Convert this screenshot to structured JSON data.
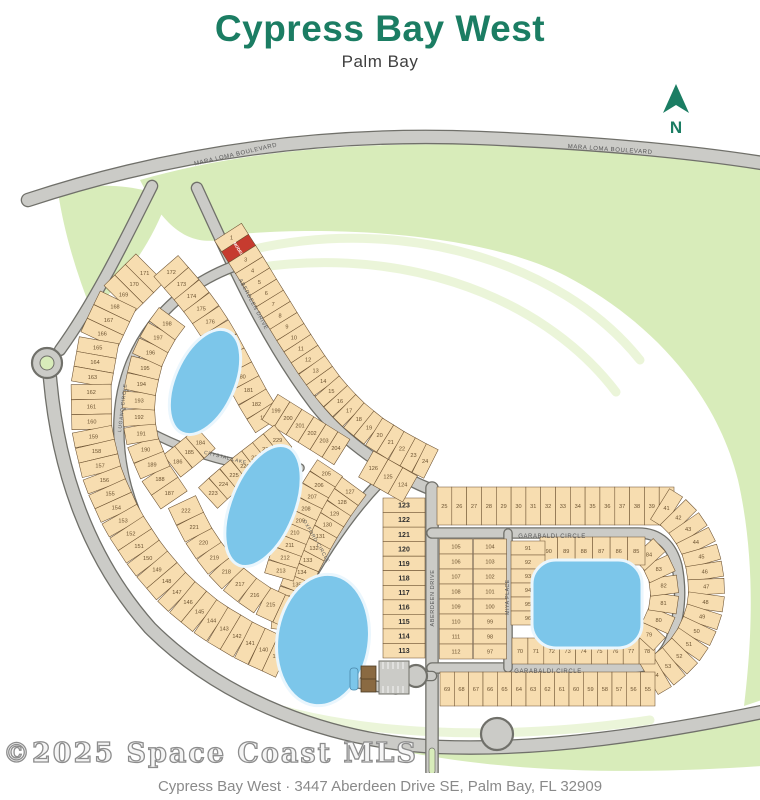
{
  "title": "Cypress Bay West",
  "subtitle": "Palm Bay",
  "watermark": "©2025 Space Coast MLS",
  "footer": "Cypress Bay West  ·  3447 Aberdeen Drive SE, Palm Bay, FL 32909",
  "north_label": "N",
  "colors": {
    "title_teal": "#1b7d63",
    "lot_fill": "#f7ddb0",
    "lot_stroke": "#6a4f2e",
    "lot_number": "#6b5230",
    "lot_number_bold": "#2f2f2f",
    "road_fill": "#cbcbc7",
    "road_casing": "#70706a",
    "green": "#d8ecba",
    "green_light": "#e6f3cf",
    "lake": "#7cc6ea",
    "lake_edge": "#eaf6fd",
    "model_red": "#c63b2f",
    "label_gray": "#575757",
    "clubhouse_brown": "#8a6a42"
  },
  "map": {
    "greens": [
      {
        "name": "green-top-right",
        "d": "M 140,180 C 300,134 500,136 762,166 L 762,700 L 744,706 C 752,640 756,560 738,480 C 716,392 650,320 566,276 C 480,232 330,226 240,234 C 200,250 170,240 140,180 Z"
      },
      {
        "name": "green-top-left",
        "d": "M 58,192 C 95,182 135,184 168,198 C 150,248 122,282 92,312 C 76,272 64,232 58,192 Z"
      },
      {
        "name": "green-bottom",
        "d": "M 150,636 C 240,718 360,752 470,752 C 600,752 690,735 762,714 L 762,766 C 560,780 300,772 150,636 Z"
      }
    ],
    "green_stripes": [
      {
        "d": "M 250,250 C 400,215 560,260 640,360"
      },
      {
        "d": "M 232,272 C 390,240 540,292 616,392"
      },
      {
        "d": "M 250,700 C 350,736 500,742 650,720"
      }
    ],
    "roads": [
      {
        "name": "mara-loma-boulevard",
        "d": "M 28,200 C 180,150 330,132 480,138 C 600,143 692,152 762,163",
        "w": 12
      },
      {
        "name": "entry-branch",
        "d": "M 152,186 C 125,240 96,300 60,350",
        "w": 10
      },
      {
        "name": "perimeter-boulevard",
        "d": "M 50,378 C 58,470 88,558 150,628 C 222,700 330,742 440,747 C 545,751 660,733 762,712",
        "w": 12
      },
      {
        "name": "aberdeen-drive-upper",
        "d": "M 197,188 C 228,255 262,335 315,405 C 345,443 390,473 432,490",
        "w": 10
      },
      {
        "name": "aberdeen-drive-lower",
        "d": "M 432,488 L 432,772",
        "w": 11
      },
      {
        "name": "garabaldi-circle-loop",
        "d": "M 432,533 L 638,533 C 660,533 672,546 677,566 C 682,592 680,616 671,639 C 663,660 648,668 628,668 L 432,668",
        "w": 9
      },
      {
        "name": "miya-place",
        "d": "M 508,533 L 508,668",
        "w": 7
      },
      {
        "name": "lugano-circle",
        "d": "M 240,264 C 165,290 122,350 119,420 C 116,495 150,562 207,606 C 237,630 272,650 312,661",
        "w": 9
      },
      {
        "name": "oxford-circle",
        "d": "M 390,472 C 355,505 325,550 301,594 C 287,620 284,646 302,660 C 322,676 355,684 396,689",
        "w": 9
      },
      {
        "name": "crystal-lake-street",
        "d": "M 150,432 C 200,458 252,471 300,468",
        "w": 7
      },
      {
        "name": "amenity-stub",
        "d": "M 432,676 L 398,676",
        "w": 8
      }
    ],
    "road_circles": [
      {
        "name": "roundabout",
        "cx": 47,
        "cy": 363,
        "r": 15,
        "inner_green": 7
      },
      {
        "name": "cul-de-sac-bulb",
        "cx": 497,
        "cy": 734,
        "r": 16
      },
      {
        "name": "amenity-cul-de-sac",
        "cx": 416,
        "cy": 676,
        "r": 11
      }
    ],
    "lakes": [
      {
        "name": "lake-1",
        "type": "ellipse",
        "cx": 205,
        "cy": 382,
        "rx": 30,
        "ry": 56,
        "rot": 24
      },
      {
        "name": "lake-2",
        "type": "ellipse",
        "cx": 263,
        "cy": 506,
        "rx": 32,
        "ry": 64,
        "rot": 22
      },
      {
        "name": "lake-3",
        "type": "ellipse",
        "cx": 323,
        "cy": 640,
        "rx": 46,
        "ry": 66,
        "rot": 8
      },
      {
        "name": "lake-4",
        "type": "rect",
        "x": 532,
        "y": 560,
        "w": 110,
        "h": 88,
        "r": 24
      }
    ],
    "lot_groups": [
      {
        "name": "aberdeen-east-1-24",
        "depth": 32,
        "line": [
          [
            228,
            232
          ],
          [
            246,
            260
          ],
          [
            262,
            286
          ],
          [
            278,
            312
          ],
          [
            294,
            338
          ],
          [
            311,
            364
          ],
          [
            329,
            389
          ],
          [
            350,
            412
          ],
          [
            373,
            431
          ],
          [
            397,
            446
          ],
          [
            419,
            458
          ],
          [
            431,
            464
          ]
        ],
        "numbers": [
          "1",
          "MODEL",
          "3",
          "4",
          "5",
          "6",
          "7",
          "8",
          "9",
          "10",
          "11",
          "12",
          "13",
          "14",
          "15",
          "16",
          "17",
          "18",
          "19",
          "20",
          "21",
          "22",
          "23",
          "24"
        ]
      },
      {
        "name": "garabaldi-top-25-40",
        "depth": 38,
        "line": [
          [
            437,
            506
          ],
          [
            674,
            506
          ]
        ],
        "numbers": [
          "25",
          "26",
          "27",
          "28",
          "29",
          "30",
          "31",
          "32",
          "33",
          "34",
          "35",
          "36",
          "37",
          "38",
          "39",
          "40"
        ]
      },
      {
        "name": "garabaldi-east-41-54",
        "depth": 36,
        "line": [
          [
            660,
            504
          ],
          [
            676,
            514
          ],
          [
            689,
            529
          ],
          [
            699,
            548
          ],
          [
            705,
            569
          ],
          [
            707,
            591
          ],
          [
            704,
            613
          ],
          [
            696,
            634
          ],
          [
            683,
            653
          ],
          [
            666,
            669
          ],
          [
            649,
            679
          ]
        ],
        "numbers": [
          "41",
          "42",
          "43",
          "44",
          "45",
          "46",
          "47",
          "48",
          "49",
          "50",
          "51",
          "52",
          "53",
          "54"
        ]
      },
      {
        "name": "garabaldi-bottom-55-69",
        "depth": 34,
        "line": [
          [
            440,
            689
          ],
          [
            655,
            689
          ]
        ],
        "numbers": [
          "69",
          "68",
          "67",
          "66",
          "65",
          "64",
          "63",
          "62",
          "61",
          "60",
          "59",
          "58",
          "57",
          "56",
          "55"
        ]
      },
      {
        "name": "inner-row-70-78",
        "depth": 26,
        "line": [
          [
            512,
            651
          ],
          [
            655,
            651
          ]
        ],
        "numbers": [
          "70",
          "71",
          "72",
          "73",
          "74",
          "75",
          "76",
          "77",
          "78"
        ]
      },
      {
        "name": "lake-east-79-84",
        "depth": 28,
        "line": [
          [
            643,
            641
          ],
          [
            656,
            627
          ],
          [
            663,
            610
          ],
          [
            665,
            592
          ],
          [
            662,
            574
          ],
          [
            654,
            559
          ],
          [
            643,
            548
          ]
        ],
        "numbers": [
          "79",
          "80",
          "81",
          "82",
          "83",
          "84"
        ]
      },
      {
        "name": "lake-north-85-90",
        "depth": 28,
        "line": [
          [
            645,
            551
          ],
          [
            540,
            551
          ]
        ],
        "numbers": [
          "85",
          "86",
          "87",
          "88",
          "89",
          "90"
        ]
      },
      {
        "name": "miya-east-91-96",
        "depth": 34,
        "line": [
          [
            528,
            541
          ],
          [
            528,
            625
          ]
        ],
        "numbers": [
          "91",
          "92",
          "93",
          "94",
          "95",
          "96"
        ]
      },
      {
        "name": "miya-west-97-104",
        "depth": 33,
        "line": [
          [
            490,
            539
          ],
          [
            490,
            659
          ]
        ],
        "numbers": [
          "104",
          "103",
          "102",
          "101",
          "100",
          "99",
          "98",
          "97"
        ]
      },
      {
        "name": "aberdeen-east-105-112",
        "depth": 33,
        "line": [
          [
            456,
            539
          ],
          [
            456,
            659
          ]
        ],
        "numbers": [
          "105",
          "106",
          "107",
          "108",
          "109",
          "110",
          "111",
          "112"
        ]
      },
      {
        "name": "aberdeen-west-113-123",
        "depth": 42,
        "font": 7,
        "bold": true,
        "line": [
          [
            404,
            498
          ],
          [
            404,
            658
          ]
        ],
        "numbers": [
          "123",
          "122",
          "121",
          "120",
          "119",
          "118",
          "117",
          "116",
          "115",
          "114",
          "113"
        ]
      },
      {
        "name": "oxford-upper-124-126",
        "depth": 30,
        "line": [
          [
            410,
            489
          ],
          [
            366,
            464
          ]
        ],
        "numbers": [
          "124",
          "125",
          "126"
        ]
      },
      {
        "name": "oxford-east-127-138",
        "depth": 30,
        "line": [
          [
            354,
            486
          ],
          [
            340,
            505
          ],
          [
            327,
            525
          ],
          [
            315,
            546
          ],
          [
            304,
            567
          ],
          [
            295,
            589
          ],
          [
            288,
            610
          ],
          [
            286,
            630
          ]
        ],
        "numbers": [
          "127",
          "128",
          "129",
          "130",
          "131",
          "132",
          "133",
          "134",
          "135",
          "136",
          "137",
          "138"
        ]
      },
      {
        "name": "outer-crescent-139-171",
        "depth": 40,
        "line": [
          [
            150,
            268
          ],
          [
            118,
            300
          ],
          [
            99,
            340
          ],
          [
            91,
            385
          ],
          [
            92,
            432
          ],
          [
            103,
            478
          ],
          [
            122,
            520
          ],
          [
            147,
            558
          ],
          [
            176,
            592
          ],
          [
            210,
            620
          ],
          [
            247,
            642
          ],
          [
            284,
            659
          ]
        ],
        "numbers": [
          "171",
          "170",
          "169",
          "168",
          "167",
          "166",
          "165",
          "164",
          "163",
          "162",
          "161",
          "160",
          "159",
          "158",
          "157",
          "156",
          "155",
          "154",
          "153",
          "152",
          "151",
          "150",
          "149",
          "148",
          "147",
          "146",
          "145",
          "144",
          "143",
          "142",
          "141",
          "140",
          "139"
        ]
      },
      {
        "name": "aberdeen-west-172-183",
        "depth": 32,
        "line": [
          [
            166,
            266
          ],
          [
            186,
            289
          ],
          [
            202,
            309
          ],
          [
            214,
            327
          ],
          [
            224,
            344
          ],
          [
            233,
            361
          ],
          [
            242,
            378
          ],
          [
            251,
            395
          ],
          [
            260,
            410
          ],
          [
            269,
            424
          ]
        ],
        "numbers": [
          "172",
          "173",
          "174",
          "175",
          "176",
          "177",
          "178",
          "179",
          "180",
          "181",
          "182",
          "183"
        ]
      },
      {
        "name": "mid-184-186",
        "depth": 28,
        "line": [
          [
            172,
            466
          ],
          [
            190,
            452
          ],
          [
            206,
            438
          ]
        ],
        "numbers": [
          "186",
          "185",
          "184"
        ]
      },
      {
        "name": "lugano-east-187-198",
        "depth": 32,
        "line": [
          [
            174,
            500
          ],
          [
            155,
            472
          ],
          [
            143,
            444
          ],
          [
            138,
            416
          ],
          [
            140,
            388
          ],
          [
            147,
            360
          ],
          [
            158,
            336
          ],
          [
            172,
            317
          ]
        ],
        "numbers": [
          "187",
          "188",
          "189",
          "190",
          "191",
          "192",
          "193",
          "194",
          "195",
          "196",
          "197",
          "198"
        ]
      },
      {
        "name": "aberdeen-south-199-204",
        "depth": 30,
        "line": [
          [
            270,
            407
          ],
          [
            342,
            452
          ]
        ],
        "numbers": [
          "199",
          "200",
          "201",
          "202",
          "203",
          "204"
        ]
      },
      {
        "name": "oxford-west-205-213",
        "depth": 30,
        "line": [
          [
            330,
            468
          ],
          [
            318,
            486
          ],
          [
            308,
            504
          ],
          [
            299,
            523
          ],
          [
            291,
            542
          ],
          [
            284,
            560
          ],
          [
            279,
            577
          ]
        ],
        "numbers": [
          "205",
          "206",
          "207",
          "208",
          "209",
          "210",
          "211",
          "212",
          "213"
        ]
      },
      {
        "name": "lake-ring-214-222",
        "depth": 30,
        "line": [
          [
            296,
            616
          ],
          [
            263,
            601
          ],
          [
            237,
            583
          ],
          [
            217,
            562
          ],
          [
            201,
            540
          ],
          [
            189,
            517
          ],
          [
            182,
            502
          ]
        ],
        "numbers": [
          "214",
          "215",
          "216",
          "217",
          "218",
          "219",
          "220",
          "221",
          "222"
        ]
      },
      {
        "name": "lake-ring-223-229",
        "depth": 28,
        "line": [
          [
            208,
            498
          ],
          [
            221,
            486
          ],
          [
            235,
            474
          ],
          [
            249,
            463
          ],
          [
            262,
            453
          ],
          [
            273,
            444
          ],
          [
            283,
            436
          ]
        ],
        "numbers": [
          "223",
          "224",
          "225",
          "226",
          "227",
          "228",
          "229"
        ]
      }
    ],
    "street_labels": [
      {
        "text": "MARA LOMA BOULEVARD",
        "x": 236,
        "y": 156,
        "rot": -13,
        "size": 6
      },
      {
        "text": "MARA LOMA BOULEVARD",
        "x": 610,
        "y": 151,
        "rot": 4,
        "size": 6
      },
      {
        "text": "ABERDEEN DRIVE",
        "x": 252,
        "y": 305,
        "rot": 62,
        "size": 5.5
      },
      {
        "text": "ABERDEEN DRIVE",
        "x": 434,
        "y": 598,
        "rot": -90,
        "size": 5.5
      },
      {
        "text": "GARABALDI CIRCLE",
        "x": 552,
        "y": 538,
        "rot": 0,
        "size": 6
      },
      {
        "text": "GARABALDI CIRCLE",
        "x": 548,
        "y": 673,
        "rot": 0,
        "size": 6
      },
      {
        "text": "MIYA PLACE",
        "x": 509,
        "y": 597,
        "rot": -90,
        "size": 5
      },
      {
        "text": "LUGANO CIRCLE",
        "x": 124,
        "y": 408,
        "rot": -83,
        "size": 5
      },
      {
        "text": "OXFORD CIRCLE",
        "x": 315,
        "y": 542,
        "rot": 60,
        "size": 5
      },
      {
        "text": "CRYSTAL LAKE",
        "x": 225,
        "y": 459,
        "rot": 14,
        "size": 5
      }
    ],
    "amenity": {
      "pool": {
        "x": 350,
        "y": 668,
        "w": 8,
        "h": 22
      },
      "clubhouse": {
        "x": 361,
        "y": 666,
        "w": 15,
        "h": 26
      },
      "parking": {
        "x": 379,
        "y": 661,
        "w": 30,
        "h": 33
      },
      "entrance_median": {
        "x": 429,
        "y": 748,
        "w": 6,
        "h": 26
      }
    },
    "north_arrow": {
      "x": 676,
      "y": 100
    }
  }
}
